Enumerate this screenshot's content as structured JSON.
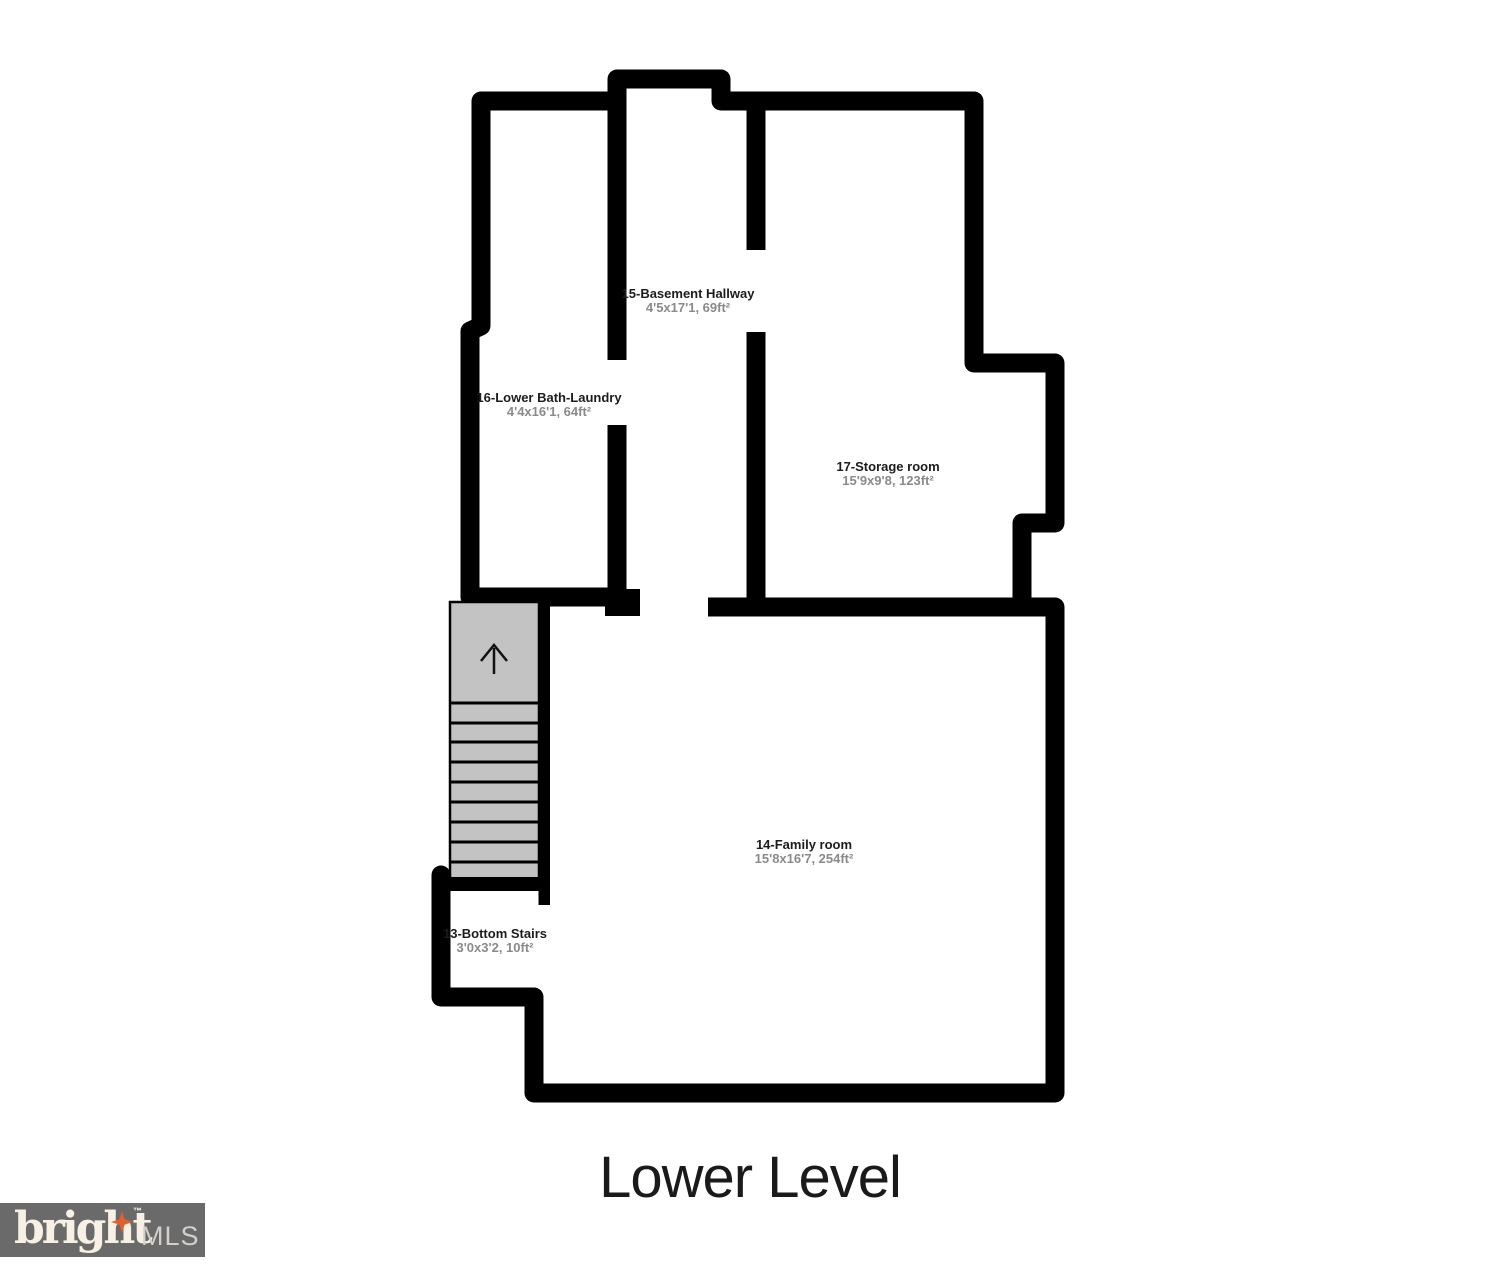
{
  "floorplan": {
    "title": "Lower Level",
    "rooms": [
      {
        "name": "15-Basement Hallway",
        "dims": "4'5x17'1, 69ft²"
      },
      {
        "name": "16-Lower Bath-Laundry",
        "dims": "4'4x16'1, 64ft²"
      },
      {
        "name": "17-Storage room",
        "dims": "15'9x9'8, 123ft²"
      },
      {
        "name": "14-Family room",
        "dims": "15'8x16'7, 254ft²"
      },
      {
        "name": "13-Bottom Stairs",
        "dims": "3'0x3'2, 10ft²"
      }
    ],
    "stairs": {
      "direction_icon": "up-arrow-icon",
      "tread_count": 9
    },
    "colors": {
      "wall": "#000000",
      "stairs_fill": "#c3c3c3",
      "room_name_text": "#1c1c1c",
      "room_dims_text": "#8a8a8a"
    }
  },
  "branding": {
    "logo_text": "bright",
    "trademark": "™",
    "logo_suffix": "MLS",
    "box_color": "#6a6a6a",
    "star_icon": "four-point-star",
    "star_color": "#e65f2b"
  }
}
